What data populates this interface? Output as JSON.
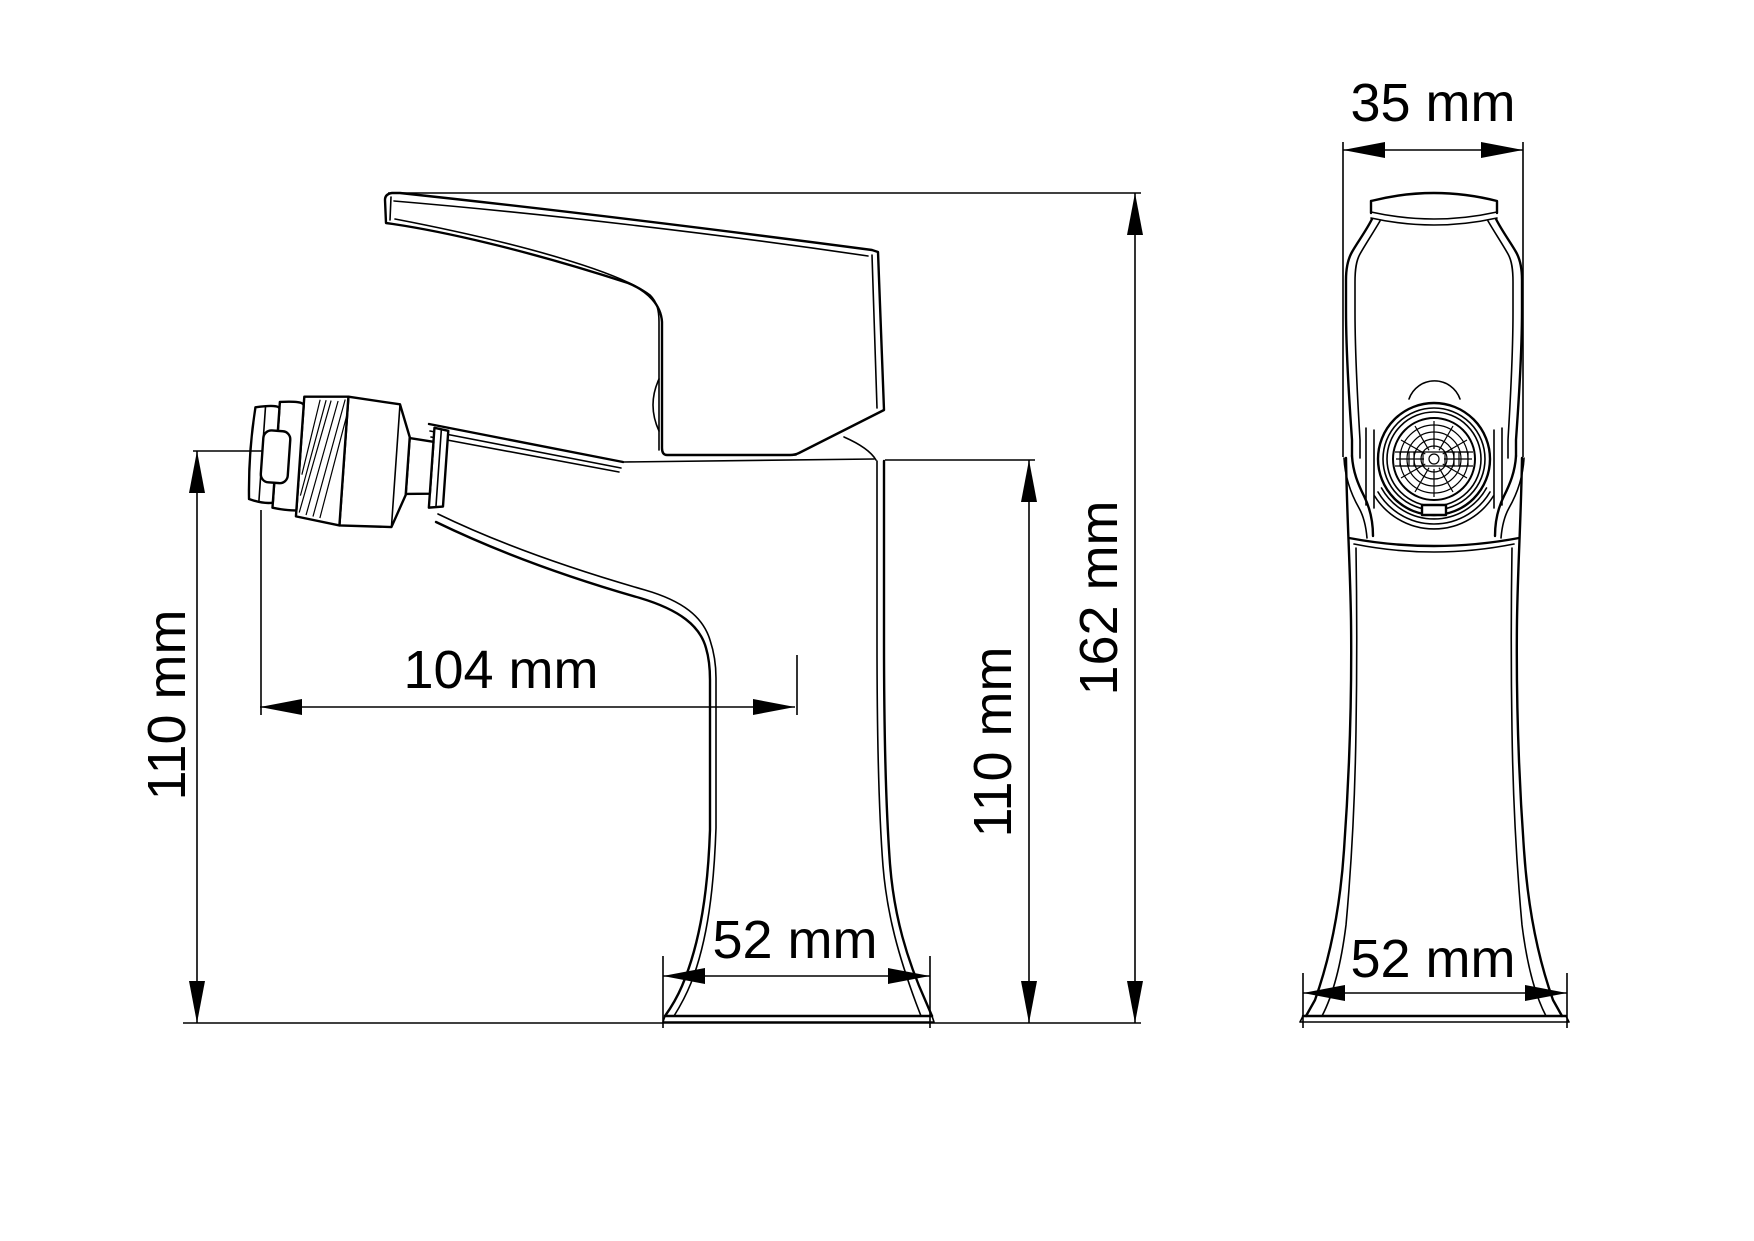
{
  "colors": {
    "background": "#ffffff",
    "line": "#000000"
  },
  "drawing": {
    "type": "technical-dimension-drawing",
    "subject": "single-lever bidet faucet, side view and front view",
    "side_view": {
      "spout_height_left": "110 mm",
      "spout_reach": "104 mm",
      "spout_height_right": "110 mm",
      "total_height": "162 mm",
      "base_width": "52 mm"
    },
    "front_view": {
      "handle_width": "35 mm",
      "base_width": "52 mm"
    }
  }
}
